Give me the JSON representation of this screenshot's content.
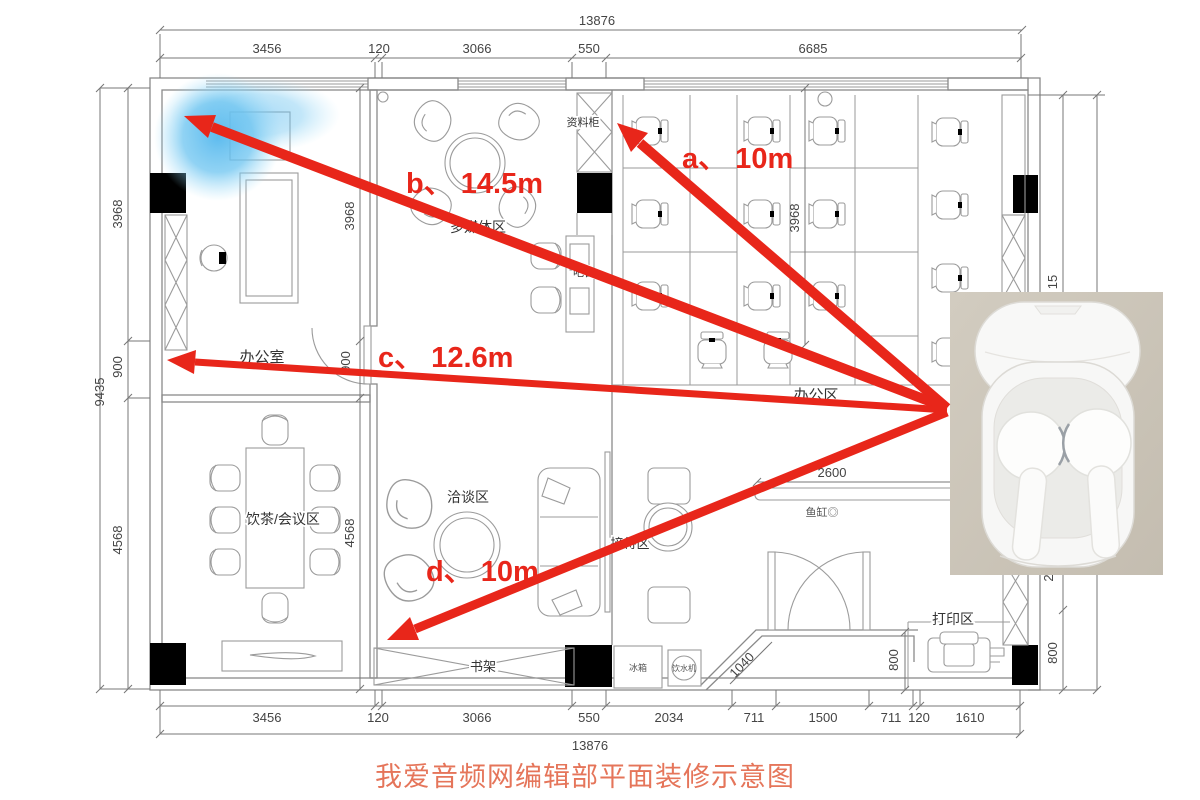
{
  "caption": "我爱音频网编辑部平面装修示意图",
  "annotations": {
    "a": "a、 10m",
    "b": "b、 14.5m",
    "c": "c、 12.6m",
    "d": "d、 10m"
  },
  "rooms": {
    "private_office": "办公室",
    "open_office": "办公区",
    "tea_meeting": "饮茶/会议区",
    "negotiation": "洽谈区",
    "reception": "接待区",
    "multimedia": "多媒体区",
    "file_cabinet": "资料柜",
    "bookshelf": "书架",
    "print_area": "打印区",
    "bar_counter": "吧台",
    "fridge": "冰箱",
    "water_dispenser": "饮水机",
    "fish_tank": "鱼缸◎"
  },
  "dims": {
    "top_total": "13876",
    "top": [
      "3456",
      "120",
      "3066",
      "550",
      "6685"
    ],
    "bottom": [
      "3456",
      "120",
      "3066",
      "550",
      "2034",
      "711",
      "1500",
      "711",
      "120",
      "1610"
    ],
    "bottom_total": "13876",
    "left_total": "9435",
    "left": [
      "3968",
      "900",
      "4568"
    ],
    "inner_left": [
      "3968",
      "900",
      "4568"
    ],
    "inner_right": "3968",
    "shelf": "2600",
    "diag": "1040",
    "entry": "800",
    "right": [
      "15",
      "2",
      "800"
    ]
  },
  "photo": {
    "ce_mark": "CE"
  },
  "colors": {
    "arrow": "#e8261a",
    "caption": "#e5755a",
    "glow": "#58b9ee"
  }
}
